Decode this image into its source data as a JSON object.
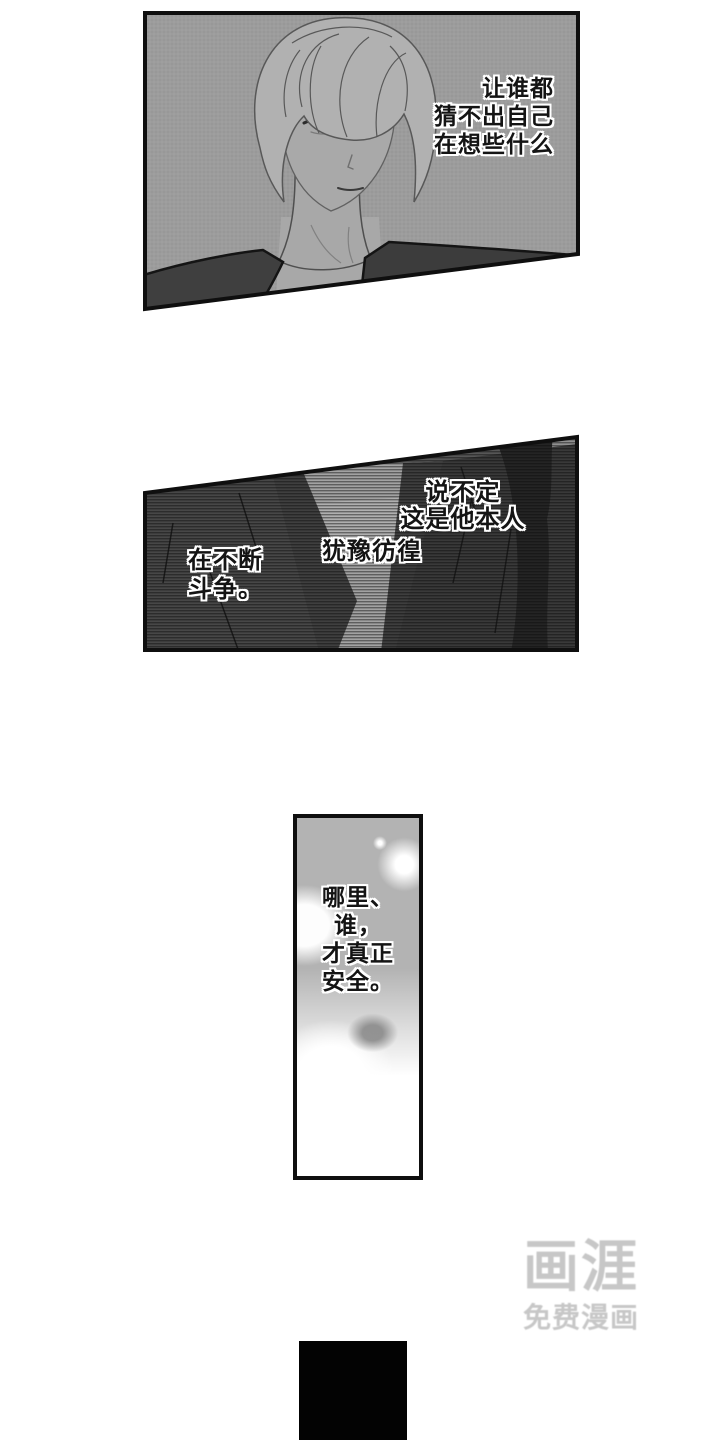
{
  "page": {
    "width": 720,
    "height": 1440,
    "background": "#ffffff"
  },
  "panel1": {
    "description": "blond man in dark jacket, grey halftone background",
    "caption_lines": [
      "让谁都",
      "猜不出自己",
      "在想些什么"
    ]
  },
  "panel2": {
    "description": "suit torso close-up with horizontal scanline shading",
    "caption_right_lines": [
      "说不定",
      "这是他本人"
    ],
    "caption_center": "犹豫彷徨",
    "caption_left_lines": [
      "在不断",
      "斗争。"
    ]
  },
  "panel3": {
    "description": "tall narrow panel, blurry soft light blobs",
    "caption_lines": [
      "哪里、",
      "谁，",
      "才真正",
      "安全。"
    ]
  },
  "watermark": {
    "logo": "画涯",
    "tagline": "免费漫画",
    "color": "#c7c7c7"
  },
  "colors": {
    "panel_border": "#0f0f0f",
    "panel1_bg": "#9c9c9c",
    "jacket_dark": "#3d3d3d",
    "panel2_base": "#565656",
    "panel2_silhouette": "#242424",
    "panel3_base": "#b3b3b3",
    "next_panel_black": "#030303"
  }
}
